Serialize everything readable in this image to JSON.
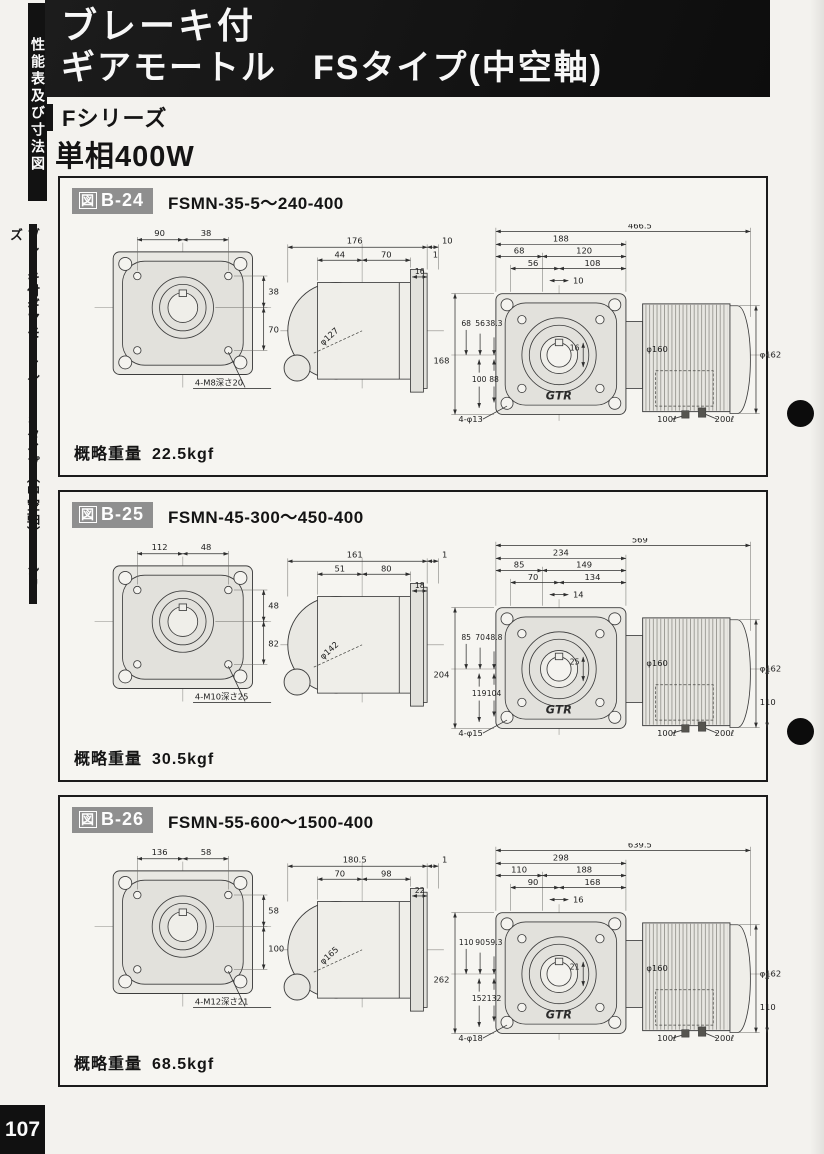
{
  "page": {
    "number": "107"
  },
  "sidebar": {
    "tab": "性能表及び寸法図",
    "label": "ブレーキ付ギアモートル　FSタイプ（中空軸）・Fシリーズ"
  },
  "header": {
    "line1": "ブレーキ付",
    "line2": "ギアモートル　FSタイプ(中空軸)",
    "series": "Fシリーズ",
    "power": "単相400W"
  },
  "colors": {
    "header_bg": "#141414",
    "badge_gray": "#8f8f8f",
    "paper": "#f3f2ee"
  },
  "figures": [
    {
      "badge_zu": "図",
      "badge_num": "B-24",
      "model": "FSMN-35-5～240-400",
      "weight_label": "概略重量",
      "weight_value": "22.5kgf",
      "front": {
        "top1": "90",
        "top2": "38",
        "right1": "38",
        "right2": "70",
        "note": "4-M8深さ20"
      },
      "side": {
        "overall": "176",
        "offset": "10",
        "a": "44",
        "b": "70",
        "c": "1",
        "flange": "16",
        "phi": "φ127"
      },
      "assembly": {
        "overall": "466.5",
        "width": "188",
        "t1": "68",
        "t2": "120",
        "t3": "56",
        "t4": "108",
        "t5": "10",
        "left_outer": "168",
        "l1": "68",
        "l2": "56",
        "l3": "38.3",
        "l4": "100",
        "l5": "88",
        "hub": "16",
        "phi_motor": "φ160",
        "phi_end": "φ162",
        "right_dim": "",
        "holes": "4-φ13",
        "oil1": "100ℓ",
        "oil2": "200ℓ",
        "logo": "GTR"
      }
    },
    {
      "badge_zu": "図",
      "badge_num": "B-25",
      "model": "FSMN-45-300～450-400",
      "weight_label": "概略重量",
      "weight_value": "30.5kgf",
      "front": {
        "top1": "112",
        "top2": "48",
        "right1": "48",
        "right2": "82",
        "note": "4-M10深さ25"
      },
      "side": {
        "overall": "161",
        "offset": "1",
        "a": "51",
        "b": "80",
        "c": "",
        "flange": "18",
        "phi": "φ142"
      },
      "assembly": {
        "overall": "569",
        "width": "234",
        "t1": "85",
        "t2": "149",
        "t3": "70",
        "t4": "134",
        "t5": "14",
        "left_outer": "204",
        "l1": "85",
        "l2": "70",
        "l3": "48.8",
        "l4": "119",
        "l5": "104",
        "hub": "25",
        "phi_motor": "φ160",
        "phi_end": "φ162",
        "right_dim": "110",
        "holes": "4-φ15",
        "oil1": "100ℓ",
        "oil2": "200ℓ",
        "logo": "GTR"
      }
    },
    {
      "badge_zu": "図",
      "badge_num": "B-26",
      "model": "FSMN-55-600～1500-400",
      "weight_label": "概略重量",
      "weight_value": "68.5kgf",
      "front": {
        "top1": "136",
        "top2": "58",
        "right1": "58",
        "right2": "100",
        "note": "4-M12深さ21"
      },
      "side": {
        "overall": "180.5",
        "offset": "1",
        "a": "70",
        "b": "98",
        "c": "",
        "flange": "22",
        "phi": "φ165"
      },
      "assembly": {
        "overall": "639.5",
        "width": "298",
        "t1": "110",
        "t2": "188",
        "t3": "90",
        "t4": "168",
        "t5": "16",
        "left_outer": "262",
        "l1": "110",
        "l2": "90",
        "l3": "59.3",
        "l4": "152",
        "l5": "132",
        "hub": "21",
        "phi_motor": "φ160",
        "phi_end": "φ162",
        "right_dim": "110",
        "holes": "4-φ18",
        "oil1": "100ℓ",
        "oil2": "200ℓ",
        "logo": "GTR"
      }
    }
  ]
}
